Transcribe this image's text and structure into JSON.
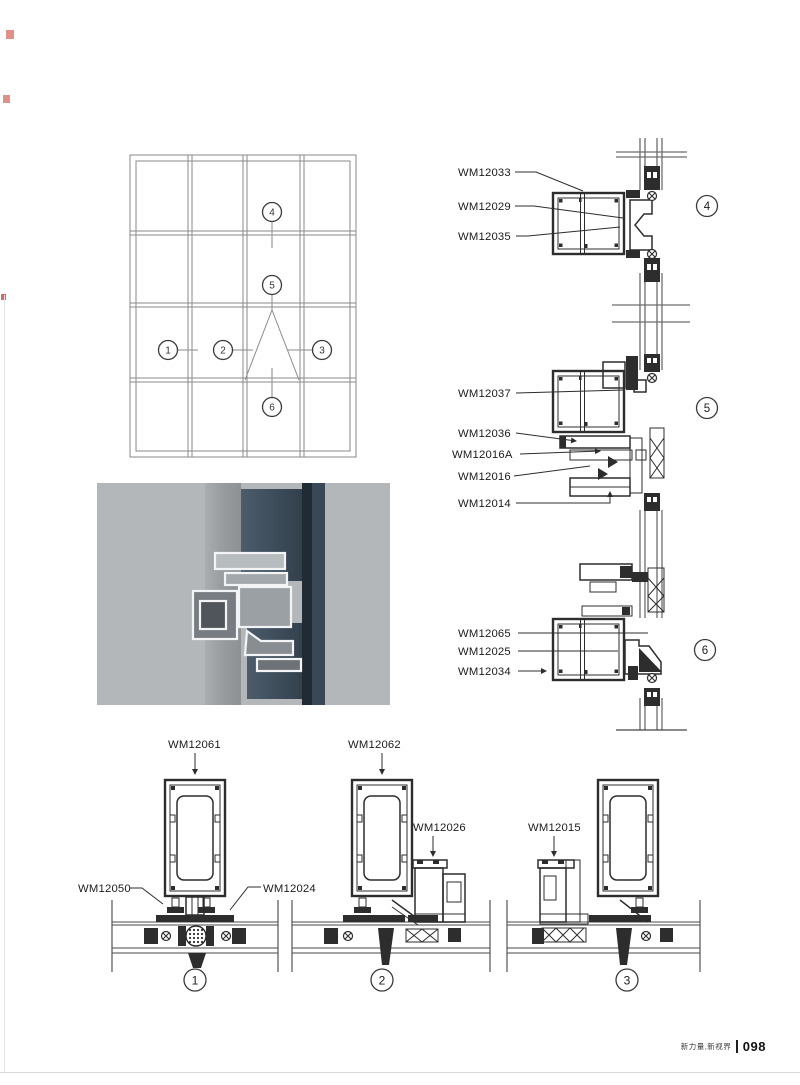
{
  "footer": {
    "slogan": "新力量,新视界",
    "page_number": "098"
  },
  "elevation": {
    "callouts": {
      "c1": "1",
      "c2": "2",
      "c3": "3",
      "c4": "4",
      "c5": "5",
      "c6": "6"
    }
  },
  "sections": {
    "s4": {
      "number": "4",
      "labels": [
        "WM12033",
        "WM12029",
        "WM12035"
      ]
    },
    "s5": {
      "number": "5",
      "labels": [
        "WM12037",
        "WM12036",
        "WM12016A",
        "WM12016",
        "WM12014"
      ]
    },
    "s6": {
      "number": "6",
      "labels": [
        "WM12065",
        "WM12025",
        "WM12034"
      ]
    },
    "s1": {
      "number": "1",
      "labels": [
        "WM12061",
        "WM12050",
        "WM12024"
      ]
    },
    "s2": {
      "number": "2",
      "labels": [
        "WM12062",
        "WM12026"
      ]
    },
    "s3": {
      "number": "3",
      "labels": [
        "WM12015"
      ]
    }
  },
  "colors": {
    "line": "#2d2d2d",
    "glass_line": "#6e6e6e",
    "photo_glass": "#33414e",
    "print_mark": "#d97d74"
  }
}
